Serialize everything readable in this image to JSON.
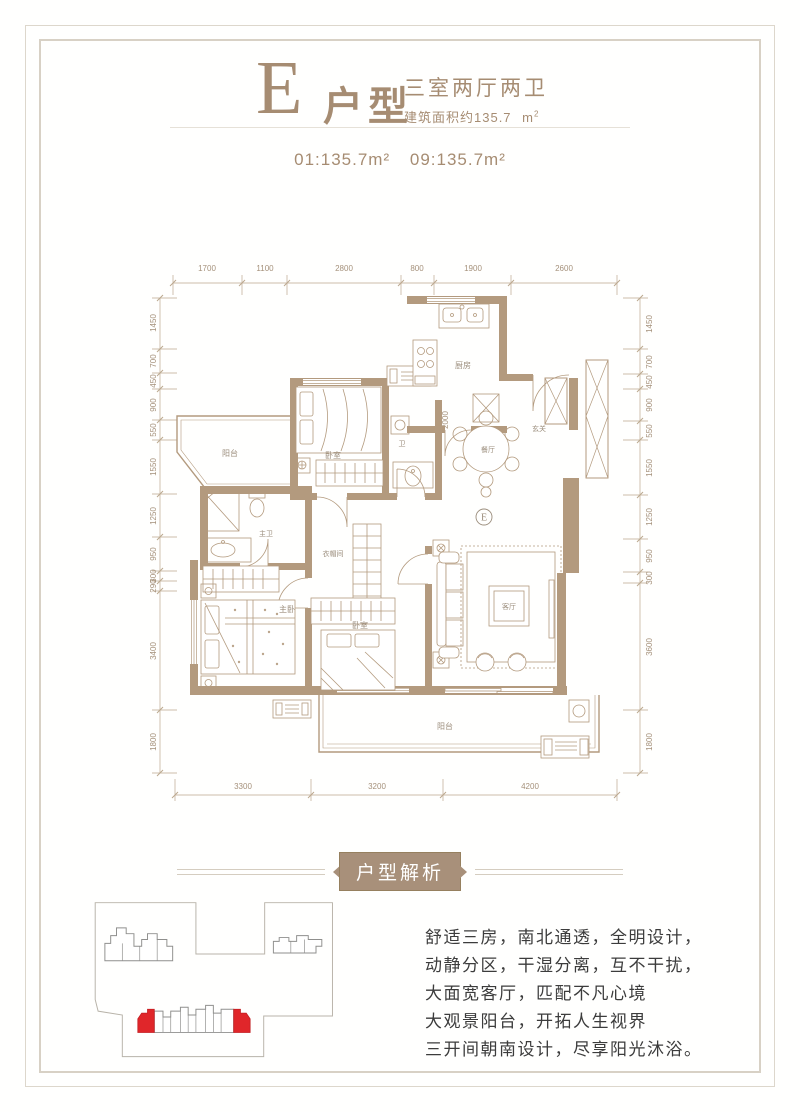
{
  "header": {
    "letter": "E",
    "type_label": "户型",
    "layout": "三室两厅两卫",
    "area_text": "建筑面积约135.7",
    "area_unit": "m",
    "area_sup": "2",
    "units": [
      "01:135.7m²",
      "09:135.7m²"
    ]
  },
  "plan": {
    "marker": "E",
    "dims_top": [
      "1700",
      "1100",
      "2800",
      "800",
      "1900",
      "2600"
    ],
    "dims_bottom": [
      "3300",
      "3200",
      "4200"
    ],
    "dims_left": [
      "1450",
      "700",
      "450",
      "900",
      "550",
      "1550",
      "1250",
      "950",
      "300",
      "290",
      "3400",
      "1800"
    ],
    "dims_right": [
      "1450",
      "700",
      "450",
      "900",
      "550",
      "1550",
      "1250",
      "950",
      "300",
      "3600",
      "1800"
    ],
    "dim_inner": "2000",
    "rooms": {
      "balcony_left": "阳台",
      "kitchen": "厨房",
      "bedroom_top": "卧室",
      "bath": "卫",
      "dining": "餐厅",
      "foyer": "玄关",
      "master_bath": "主卫",
      "cloakroom": "衣帽间",
      "master_bedroom": "主卧",
      "bedroom2": "卧室",
      "living": "客厅",
      "balcony_bottom": "阳台"
    }
  },
  "analysis": {
    "banner": "户型解析",
    "lines": [
      "舒适三房，南北通透，全明设计，",
      "动静分区，干湿分离，互不干扰，",
      "大面宽客厅，匹配不凡心境",
      "大观景阳台，开拓人生视界",
      "三开间朝南设计，尽享阳光沐浴。"
    ]
  },
  "colors": {
    "accent": "#a68c72",
    "wall": "#b39a7e",
    "highlight_red": "#e0262a",
    "body_text": "#3c3c3c",
    "frame": "#d8d1c5"
  }
}
